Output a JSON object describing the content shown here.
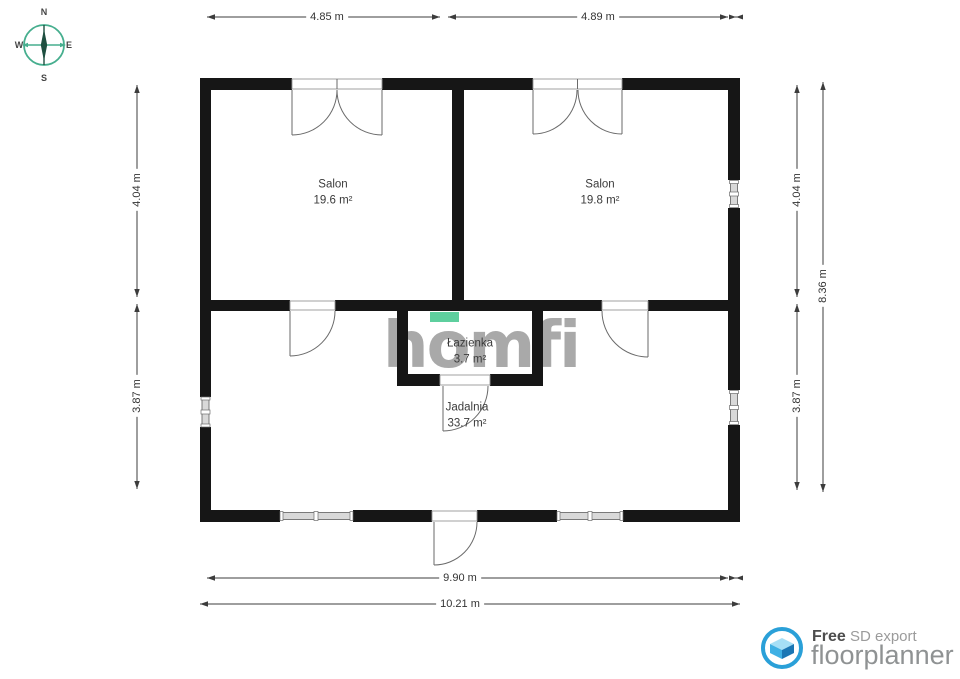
{
  "compass": {
    "n": "N",
    "e": "E",
    "s": "S",
    "w": "W"
  },
  "watermark": {
    "text": "homfi",
    "text_color": "#a9a9a9",
    "accent_color": "#5ecf9e"
  },
  "rooms": [
    {
      "name": "Salon",
      "area": "19.6 m²"
    },
    {
      "name": "Salon",
      "area": "19.8 m²"
    },
    {
      "name": "Łazienka",
      "area": "3.7 m²"
    },
    {
      "name": "Jadalnia",
      "area": "33.7 m²"
    }
  ],
  "dimensions": {
    "top_left": "4.85 m",
    "top_right": "4.89 m",
    "left_upper": "4.04 m",
    "left_lower": "3.87 m",
    "right_upper": "4.04 m",
    "right_lower": "3.87 m",
    "right_total": "8.36 m",
    "bottom_inner": "9.90 m",
    "bottom_outer": "10.21 m"
  },
  "footer": {
    "free_label": "Free",
    "export_label": "SD export",
    "brand": "floorplanner"
  },
  "colors": {
    "wall": "#161616",
    "dimension": "#3c3c3c",
    "compass_teal": "#46ae8e",
    "compass_dark": "#1e4f40",
    "footer_blue": "#2aa0d8"
  }
}
